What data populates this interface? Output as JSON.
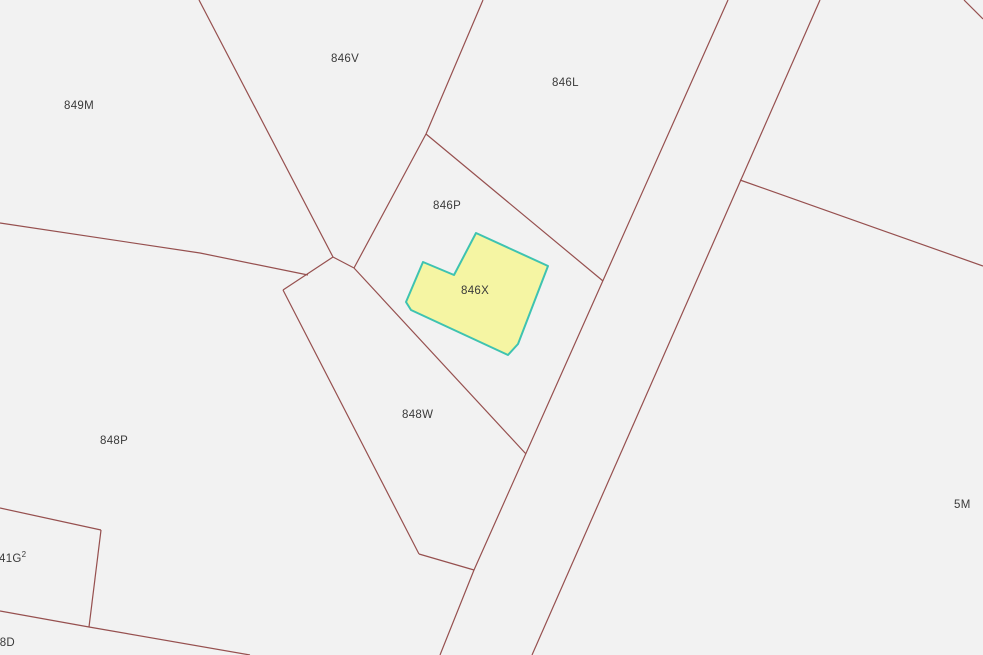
{
  "map": {
    "colors": {
      "background": "#f2f2f2",
      "boundary_line": "#96504f",
      "label_text": "#3a3a3a",
      "highlight_fill": "#f5f5a3",
      "highlight_stroke": "#3ec3b1"
    },
    "labels": [
      {
        "text": "849M",
        "x": 64,
        "y": 100
      },
      {
        "text": "846V",
        "x": 331,
        "y": 53
      },
      {
        "text": "846L",
        "x": 552,
        "y": 77
      },
      {
        "text": "846P",
        "x": 433,
        "y": 200
      },
      {
        "text": "846X",
        "x": 461,
        "y": 285
      },
      {
        "text": "848W",
        "x": 402,
        "y": 409
      },
      {
        "text": "848P",
        "x": 100,
        "y": 435
      },
      {
        "text": "41G",
        "sup": "2",
        "x": -1,
        "y": 553
      },
      {
        "text": "48D",
        "x": -7,
        "y": 637
      },
      {
        "text": "5M",
        "x": 954,
        "y": 499
      }
    ],
    "highlight_parcel": {
      "label": "846X",
      "fill": "#f5f5a3",
      "stroke": "#3ec3b1",
      "stroke_width": 2,
      "points": [
        [
          476,
          233
        ],
        [
          548,
          266
        ],
        [
          518,
          344
        ],
        [
          508,
          355
        ],
        [
          411,
          310
        ],
        [
          406,
          302
        ],
        [
          423,
          262
        ],
        [
          454,
          275
        ]
      ]
    },
    "boundary_lines": [
      {
        "id": "top-left-to-knot",
        "points": [
          [
            199,
            0
          ],
          [
            333,
            257
          ]
        ]
      },
      {
        "id": "top-to-junction",
        "points": [
          [
            483,
            0
          ],
          [
            426,
            134
          ]
        ]
      },
      {
        "id": "junction-to-knot",
        "points": [
          [
            426,
            134
          ],
          [
            354,
            268
          ]
        ]
      },
      {
        "id": "junction-to-road",
        "points": [
          [
            426,
            134
          ],
          [
            603,
            281
          ]
        ]
      },
      {
        "id": "knot-short-edge",
        "points": [
          [
            333,
            257
          ],
          [
            354,
            268
          ]
        ]
      },
      {
        "id": "knot-to-corner",
        "points": [
          [
            333,
            257
          ],
          [
            283,
            290
          ]
        ]
      },
      {
        "id": "left-horizontal",
        "points": [
          [
            0,
            223
          ],
          [
            200,
            253
          ],
          [
            308,
            275
          ]
        ]
      },
      {
        "id": "848w-left-edge",
        "points": [
          [
            283,
            290
          ],
          [
            419,
            554
          ]
        ]
      },
      {
        "id": "848w-bottom-edge",
        "points": [
          [
            419,
            554
          ],
          [
            474,
            570
          ]
        ]
      },
      {
        "id": "846p-848w-diagonal",
        "points": [
          [
            354,
            268
          ],
          [
            526,
            454
          ]
        ]
      },
      {
        "id": "road-left-line",
        "points": [
          [
            728,
            0
          ],
          [
            474,
            570
          ],
          [
            440,
            655
          ]
        ]
      },
      {
        "id": "road-right-line",
        "points": [
          [
            820,
            0
          ],
          [
            532,
            655
          ]
        ]
      },
      {
        "id": "branch-to-right-edge",
        "points": [
          [
            740,
            180
          ],
          [
            983,
            266
          ]
        ]
      },
      {
        "id": "top-right-corner",
        "points": [
          [
            964,
            0
          ],
          [
            983,
            19
          ]
        ]
      },
      {
        "id": "41g2-top-edge",
        "points": [
          [
            0,
            508
          ],
          [
            101,
            530
          ]
        ]
      },
      {
        "id": "41g2-right-edge",
        "points": [
          [
            101,
            530
          ],
          [
            89,
            627
          ]
        ]
      },
      {
        "id": "bottom-diagonal",
        "points": [
          [
            0,
            611
          ],
          [
            89,
            627
          ],
          [
            250,
            655
          ]
        ]
      }
    ]
  }
}
